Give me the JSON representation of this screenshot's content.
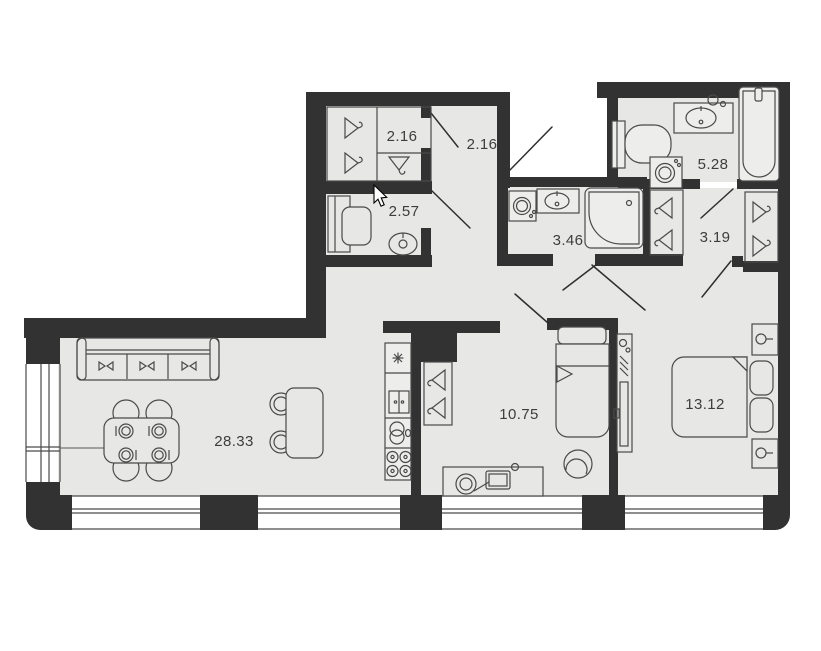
{
  "floorplan": {
    "title": "apartment-floor-plan",
    "rooms": [
      {
        "name": "closet",
        "area": "2.16"
      },
      {
        "name": "entrance-hall",
        "area": "2.16"
      },
      {
        "name": "study",
        "area": "2.57"
      },
      {
        "name": "bathroom",
        "area": "5.28"
      },
      {
        "name": "shower-room",
        "area": "3.46"
      },
      {
        "name": "wardrobe-corridor",
        "area": "3.19"
      },
      {
        "name": "living-kitchen",
        "area": "28.33"
      },
      {
        "name": "bedroom-small",
        "area": "10.75"
      },
      {
        "name": "bedroom-master",
        "area": "13.12"
      }
    ],
    "colors": {
      "wall": "#323232",
      "floor": "#e7e7e6",
      "furniture_line": "#4a4a4a",
      "label": "#3d3d3d",
      "background": "#ffffff"
    }
  }
}
